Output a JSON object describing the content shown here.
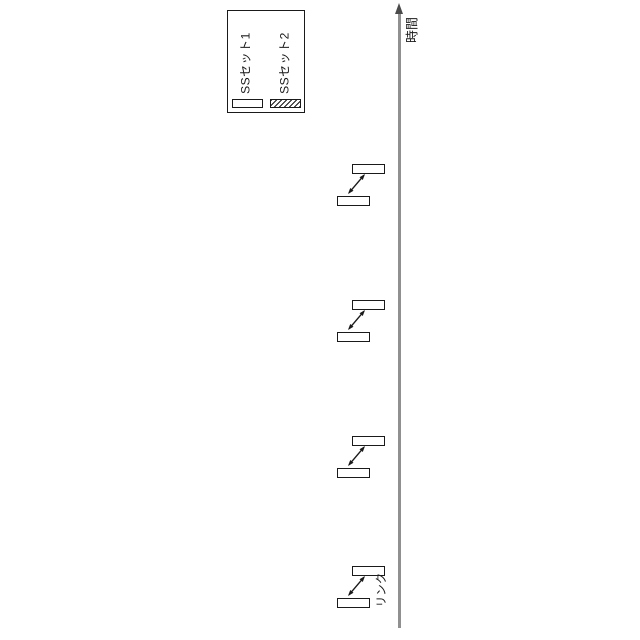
{
  "figure": {
    "legend": {
      "items": [
        {
          "label": "SSセット1",
          "swatch": "plain"
        },
        {
          "label": "SSセット2",
          "swatch": "hatched"
        }
      ]
    },
    "time_axis": {
      "label": "時間",
      "direction": "up"
    },
    "link_label": "リンク",
    "exchange_groups": [
      {
        "id": "exchange-1"
      },
      {
        "id": "exchange-2"
      },
      {
        "id": "exchange-3"
      },
      {
        "id": "exchange-4"
      }
    ],
    "colors": {
      "ink": "#1a1a1a",
      "axis_line": "#909090",
      "background": "#ffffff"
    }
  }
}
